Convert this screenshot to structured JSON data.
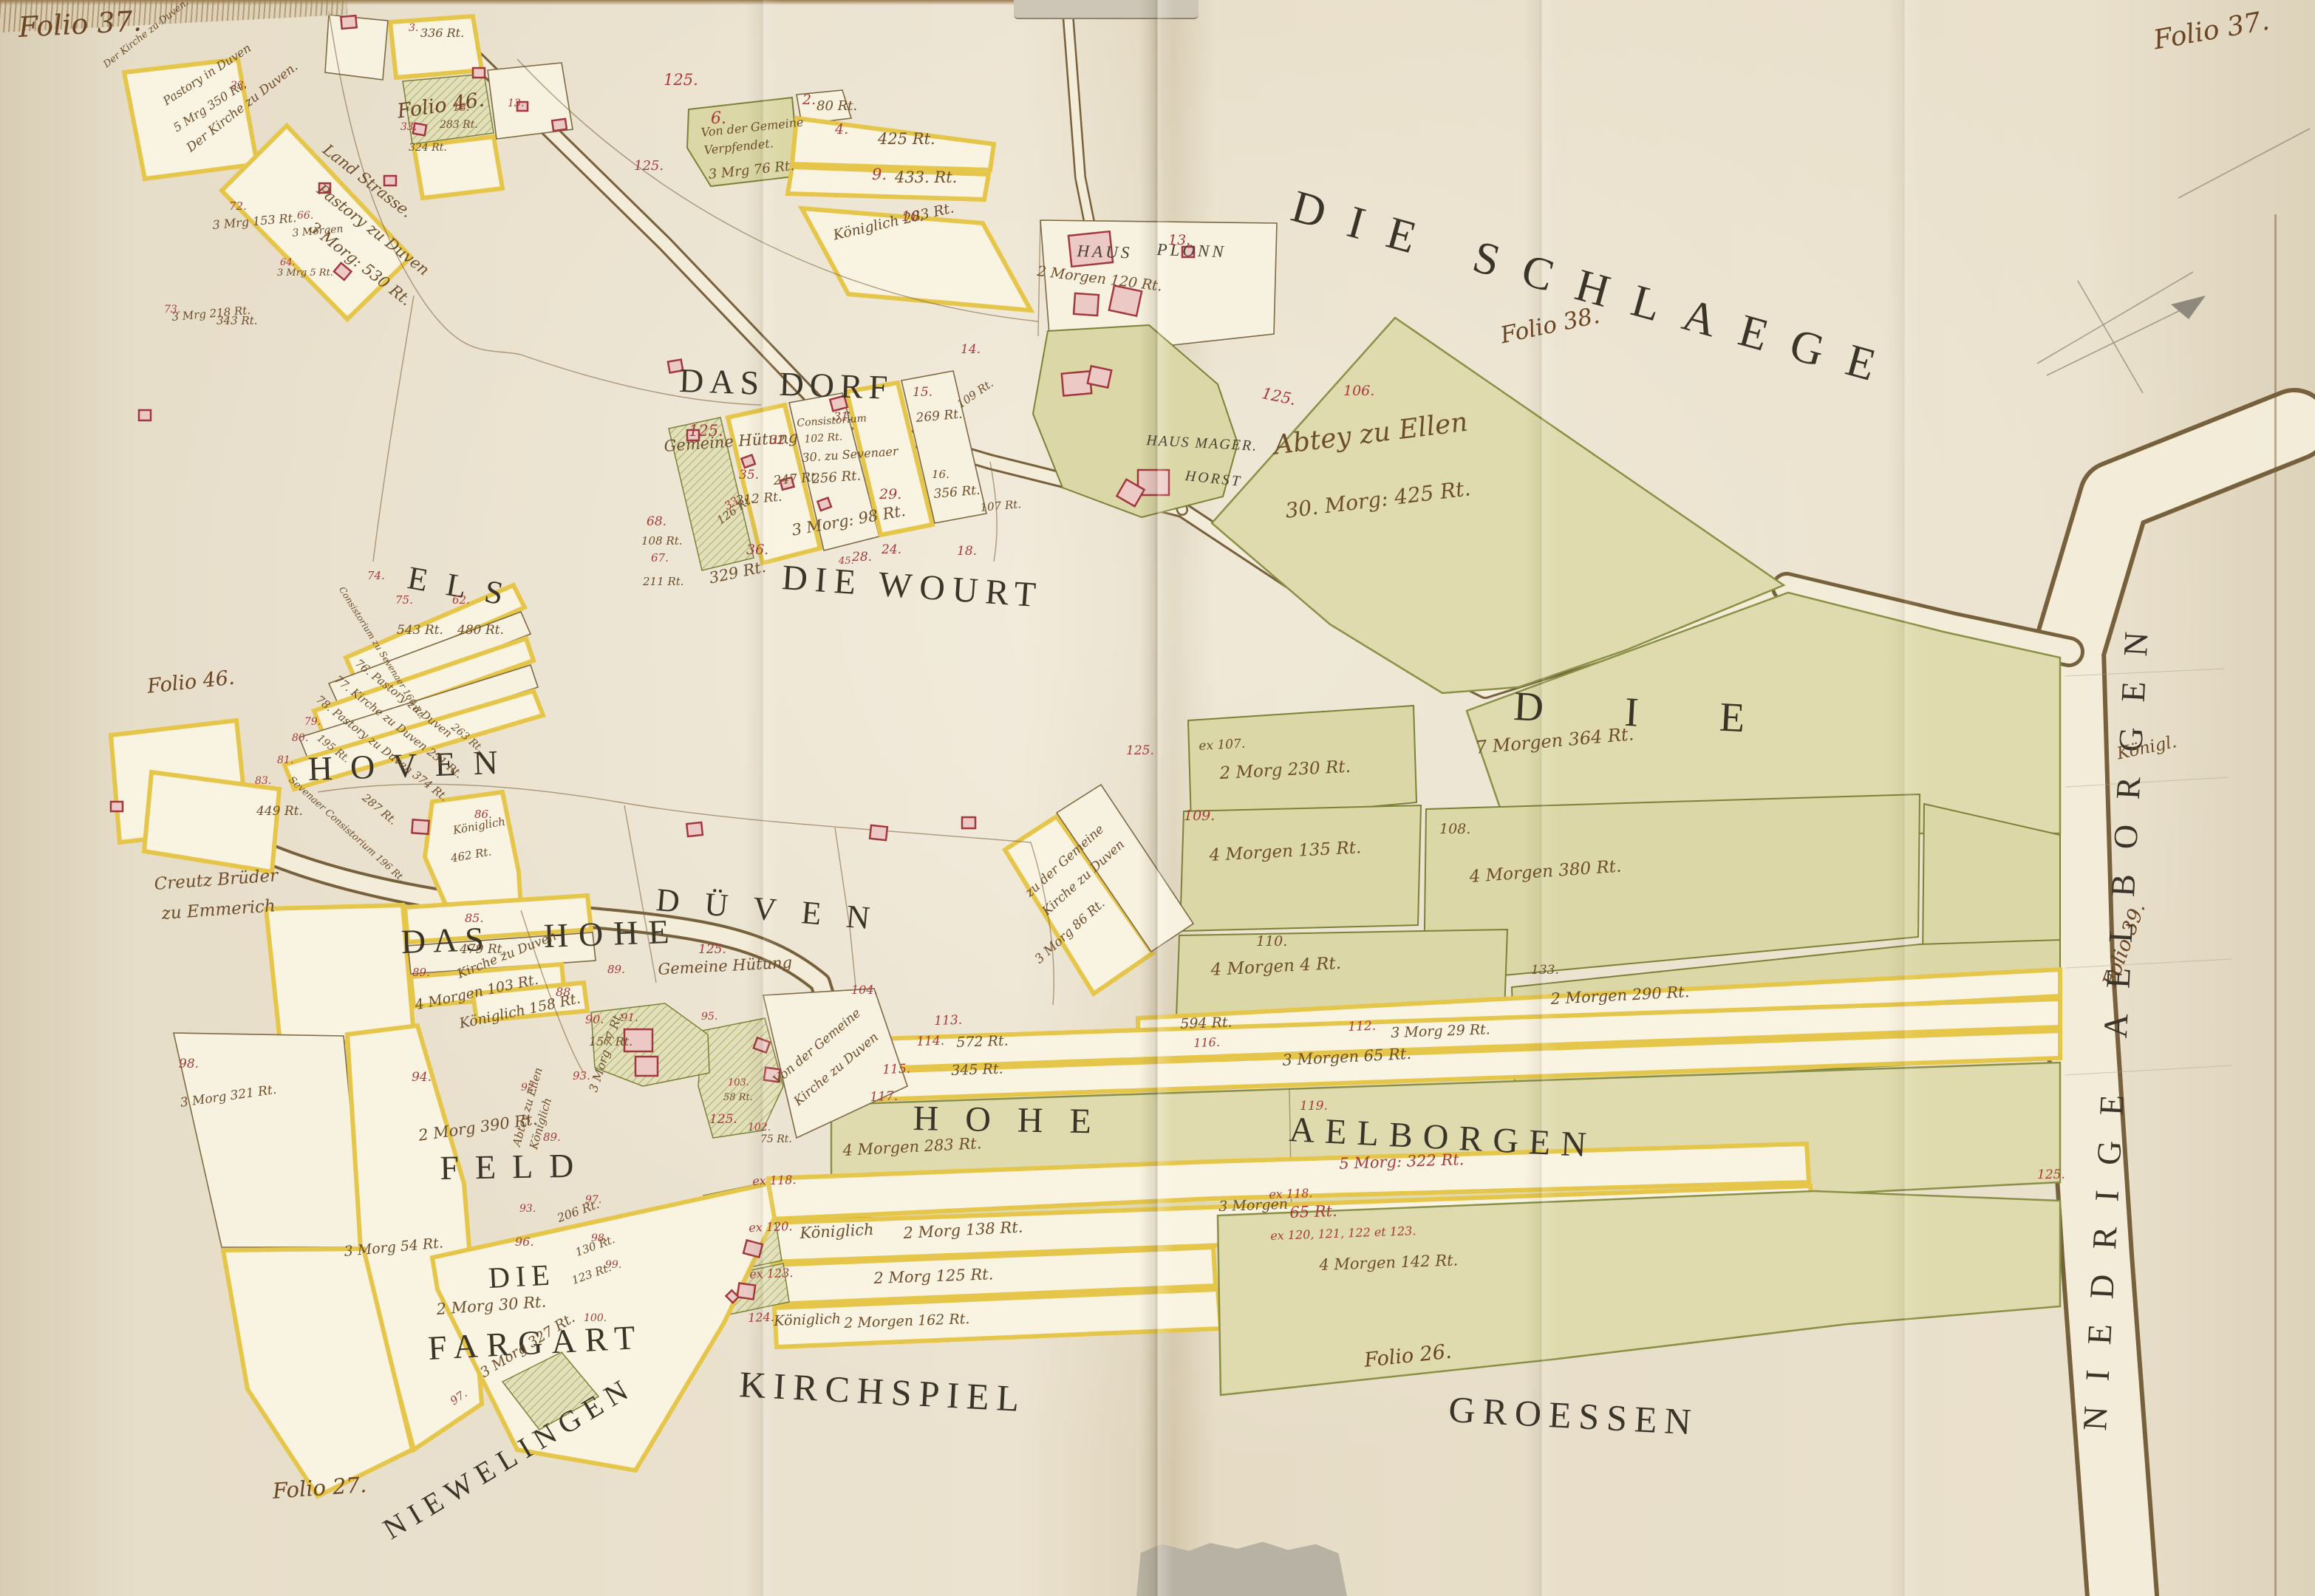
{
  "palette": {
    "paper": "#e8dfcb",
    "ink_brown": "#6d4e2c",
    "ink_red": "#a63b3b",
    "title_black": "#3b3429",
    "parcel_yellow": "#e5c64a",
    "field_green": "#dbd7a6",
    "building_red": "#a2383e",
    "building_fill": "#edc9c5",
    "road_cream": "#f3ecd8",
    "pencil_gray": "#98927f"
  },
  "folio_marks": {
    "top_left": "Folio 37.",
    "top_right": "Folio 37.",
    "upper_left": "Folio 46.",
    "mid_left": "Folio 46.",
    "schlaege": "Folio 38.",
    "right_margin": "Folio 39.",
    "bottom_center": "Folio 26.",
    "bottom_left": "Folio 27."
  },
  "region_titles": {
    "schlaege": "DIE SCHLAEGE",
    "das_dorf": "DAS DORF",
    "die_wourt": "DIE WOURT",
    "els": "ELS",
    "hoven": "HOVEN",
    "das": "DAS",
    "hohe": "HOHE",
    "dueven": "DÜVEN",
    "feld": "FELD",
    "die_fargart_die": "DIE",
    "fargart": "FARGART",
    "niewelingen": "NIEWELINGEN",
    "kirchspiel": "KIRCHSPIEL",
    "groessen": "GROESSEN",
    "hohe_right": "HOHE",
    "aelborgen": "AELBORGEN",
    "die_right": "DIE",
    "niedrige_aelborgen": "NIEDRIGE AELBORGEN"
  },
  "place_labels": {
    "haus": "HAUS",
    "plonn": "PLONN",
    "haus_mager": "HAUS MAGER.",
    "horst": "HORST",
    "abtey": "Abtey zu Ellen",
    "abtey_area": "30. Morg: 425 Rt.",
    "land_strasse": "Land Strasse.",
    "kirche_duven_mid": "Der Kirche zu Duven.",
    "pastory95": "Pastory zu Duven",
    "pastory95b": "3 Morg: 530 Rt.",
    "pastory_tl": "Pastory in Duven",
    "pastory_tlb": "5 Mrg 350 Rt.",
    "kirche_tl": "Der Kirche zu Duven.",
    "creutz1": "Creutz Brüder",
    "creutz2": "zu Emmerich",
    "koenigl": "Königl."
  },
  "notes": [
    {
      "t": "6."
    },
    {
      "t": "Von der Gemeine"
    },
    {
      "t": "Verpfendet."
    },
    {
      "t": "3 Mrg 76 Rt."
    },
    {
      "t": "2."
    },
    {
      "t": "80 Rt."
    },
    {
      "t": "4."
    },
    {
      "t": "425 Rt."
    },
    {
      "t": "9."
    },
    {
      "t": "433. Rt."
    },
    {
      "t": "10."
    },
    {
      "t": "Königlich 283 Rt."
    },
    {
      "t": "125."
    },
    {
      "t": "125."
    },
    {
      "t": "125."
    },
    {
      "t": "Gemeine Hütung"
    },
    {
      "t": "31."
    },
    {
      "t": "Consistorium"
    },
    {
      "t": "102 Rt."
    },
    {
      "t": "30. zu Sevenaer"
    },
    {
      "t": "256 Rt."
    },
    {
      "t": "32."
    },
    {
      "t": "247 Rt."
    },
    {
      "t": "35."
    },
    {
      "t": "212 Rt."
    },
    {
      "t": "33."
    },
    {
      "t": "126 Rt."
    },
    {
      "t": "36."
    },
    {
      "t": "329 Rt."
    },
    {
      "t": "3 Morg: 98 Rt."
    },
    {
      "t": "29."
    },
    {
      "t": "28."
    },
    {
      "t": "24."
    },
    {
      "t": "45."
    },
    {
      "t": "18."
    },
    {
      "t": "16."
    },
    {
      "t": "356 Rt."
    },
    {
      "t": "107 Rt."
    },
    {
      "t": "15."
    },
    {
      "t": "269 Rt."
    },
    {
      "t": "109 Rt."
    },
    {
      "t": "14."
    },
    {
      "t": "68."
    },
    {
      "t": "108 Rt."
    },
    {
      "t": "67."
    },
    {
      "t": "211 Rt."
    },
    {
      "t": "13."
    },
    {
      "t": "2 Morgen 120 Rt."
    },
    {
      "t": "125."
    },
    {
      "t": "106."
    },
    {
      "t": "ex 107."
    },
    {
      "t": "2 Morg 230 Rt."
    },
    {
      "t": "109."
    },
    {
      "t": "4 Morgen 135 Rt."
    },
    {
      "t": "108."
    },
    {
      "t": "4 Morgen 380 Rt."
    },
    {
      "t": "110."
    },
    {
      "t": "4 Morgen 4 Rt."
    },
    {
      "t": "133."
    },
    {
      "t": "2 Morgen 290 Rt."
    },
    {
      "t": "7 Morgen 364 Rt."
    },
    {
      "t": "113."
    },
    {
      "t": "114."
    },
    {
      "t": "572 Rt."
    },
    {
      "t": "115."
    },
    {
      "t": "345 Rt."
    },
    {
      "t": "117."
    },
    {
      "t": "4 Morgen 283 Rt."
    },
    {
      "t": "594 Rt."
    },
    {
      "t": "116."
    },
    {
      "t": "112."
    },
    {
      "t": "3 Morg 29 Rt."
    },
    {
      "t": "3 Morgen 65 Rt."
    },
    {
      "t": "119."
    },
    {
      "t": "5 Morg: 322 Rt."
    },
    {
      "t": "ex 118."
    },
    {
      "t": "ex 118."
    },
    {
      "t": "3 Morgen"
    },
    {
      "t": "65 Rt."
    },
    {
      "t": "ex 120."
    },
    {
      "t": "Königlich"
    },
    {
      "t": "2 Morg 138 Rt."
    },
    {
      "t": "ex 120, 121, 122 et 123."
    },
    {
      "t": "4 Morgen 142 Rt."
    },
    {
      "t": "ex 123."
    },
    {
      "t": "2 Morg 125 Rt."
    },
    {
      "t": "124."
    },
    {
      "t": "Königlich"
    },
    {
      "t": "2 Morgen 162 Rt."
    },
    {
      "t": "104."
    },
    {
      "t": "Von der Gemeine"
    },
    {
      "t": "Kirche zu Duven"
    },
    {
      "t": "95."
    },
    {
      "t": "103."
    },
    {
      "t": "58 Rt."
    },
    {
      "t": "102."
    },
    {
      "t": "75 Rt."
    },
    {
      "t": "90."
    },
    {
      "t": "157 Rt."
    },
    {
      "t": "91."
    },
    {
      "t": "85."
    },
    {
      "t": "479 Rt."
    },
    {
      "t": "Kirche zu Duven"
    },
    {
      "t": "88."
    },
    {
      "t": "4 Morgen 103 Rt."
    },
    {
      "t": "Königlich 158 Rt."
    },
    {
      "t": "94."
    },
    {
      "t": "2 Morg 390 Rt."
    },
    {
      "t": "89."
    },
    {
      "t": "89."
    },
    {
      "t": "89."
    },
    {
      "t": "93."
    },
    {
      "t": "3 Morg 77 Rt."
    },
    {
      "t": "92."
    },
    {
      "t": "Abtey zu Ellen"
    },
    {
      "t": "Königlich"
    },
    {
      "t": "93."
    },
    {
      "t": "96."
    },
    {
      "t": "206 Rt."
    },
    {
      "t": "97."
    },
    {
      "t": "130 Rt."
    },
    {
      "t": "98."
    },
    {
      "t": "99."
    },
    {
      "t": "123 Rt."
    },
    {
      "t": "100."
    },
    {
      "t": "97."
    },
    {
      "t": "2 Morg 30 Rt."
    },
    {
      "t": "3 Morg 327 Rt."
    },
    {
      "t": "3 Morg 54 Rt."
    },
    {
      "t": "98."
    },
    {
      "t": "3 Morg 321 Rt."
    },
    {
      "t": "74."
    },
    {
      "t": "75."
    },
    {
      "t": "543 Rt."
    },
    {
      "t": "62."
    },
    {
      "t": "480 Rt."
    },
    {
      "t": "76. Pastory zu Duven"
    },
    {
      "t": "77. Kirche zu Duven 231 Rt."
    },
    {
      "t": "78. Pastory zu Duven 374 Rt."
    },
    {
      "t": "79."
    },
    {
      "t": "195 Rt."
    },
    {
      "t": "80."
    },
    {
      "t": "81."
    },
    {
      "t": "Sevenaer Consistorium 196 Rt."
    },
    {
      "t": "83."
    },
    {
      "t": "449 Rt."
    },
    {
      "t": "287 Rt."
    },
    {
      "t": "Consistorium zu Sevenaer 160 Rt."
    },
    {
      "t": "86."
    },
    {
      "t": "Königlich"
    },
    {
      "t": "462 Rt."
    },
    {
      "t": "263 Rt."
    },
    {
      "t": "72."
    },
    {
      "t": "3 Mrg 153 Rt."
    },
    {
      "t": "66."
    },
    {
      "t": "3 Morgen"
    },
    {
      "t": "73."
    },
    {
      "t": "3 Mrg 218 Rt."
    },
    {
      "t": "343 Rt."
    },
    {
      "t": "64."
    },
    {
      "t": "3 Mrg 5 Rt."
    },
    {
      "t": "3."
    },
    {
      "t": "336 Rt."
    },
    {
      "t": "18."
    },
    {
      "t": "283 Rt."
    },
    {
      "t": "13."
    },
    {
      "t": "33."
    },
    {
      "t": "324 Rt."
    },
    {
      "t": "23."
    },
    {
      "t": "125."
    },
    {
      "t": "Gemeine Hütung"
    },
    {
      "t": "125."
    },
    {
      "t": "125."
    },
    {
      "t": "125."
    },
    {
      "t": "zu der Gemeine"
    },
    {
      "t": "Kirche zu Duven"
    },
    {
      "t": "3 Morg 86 Rt."
    }
  ]
}
